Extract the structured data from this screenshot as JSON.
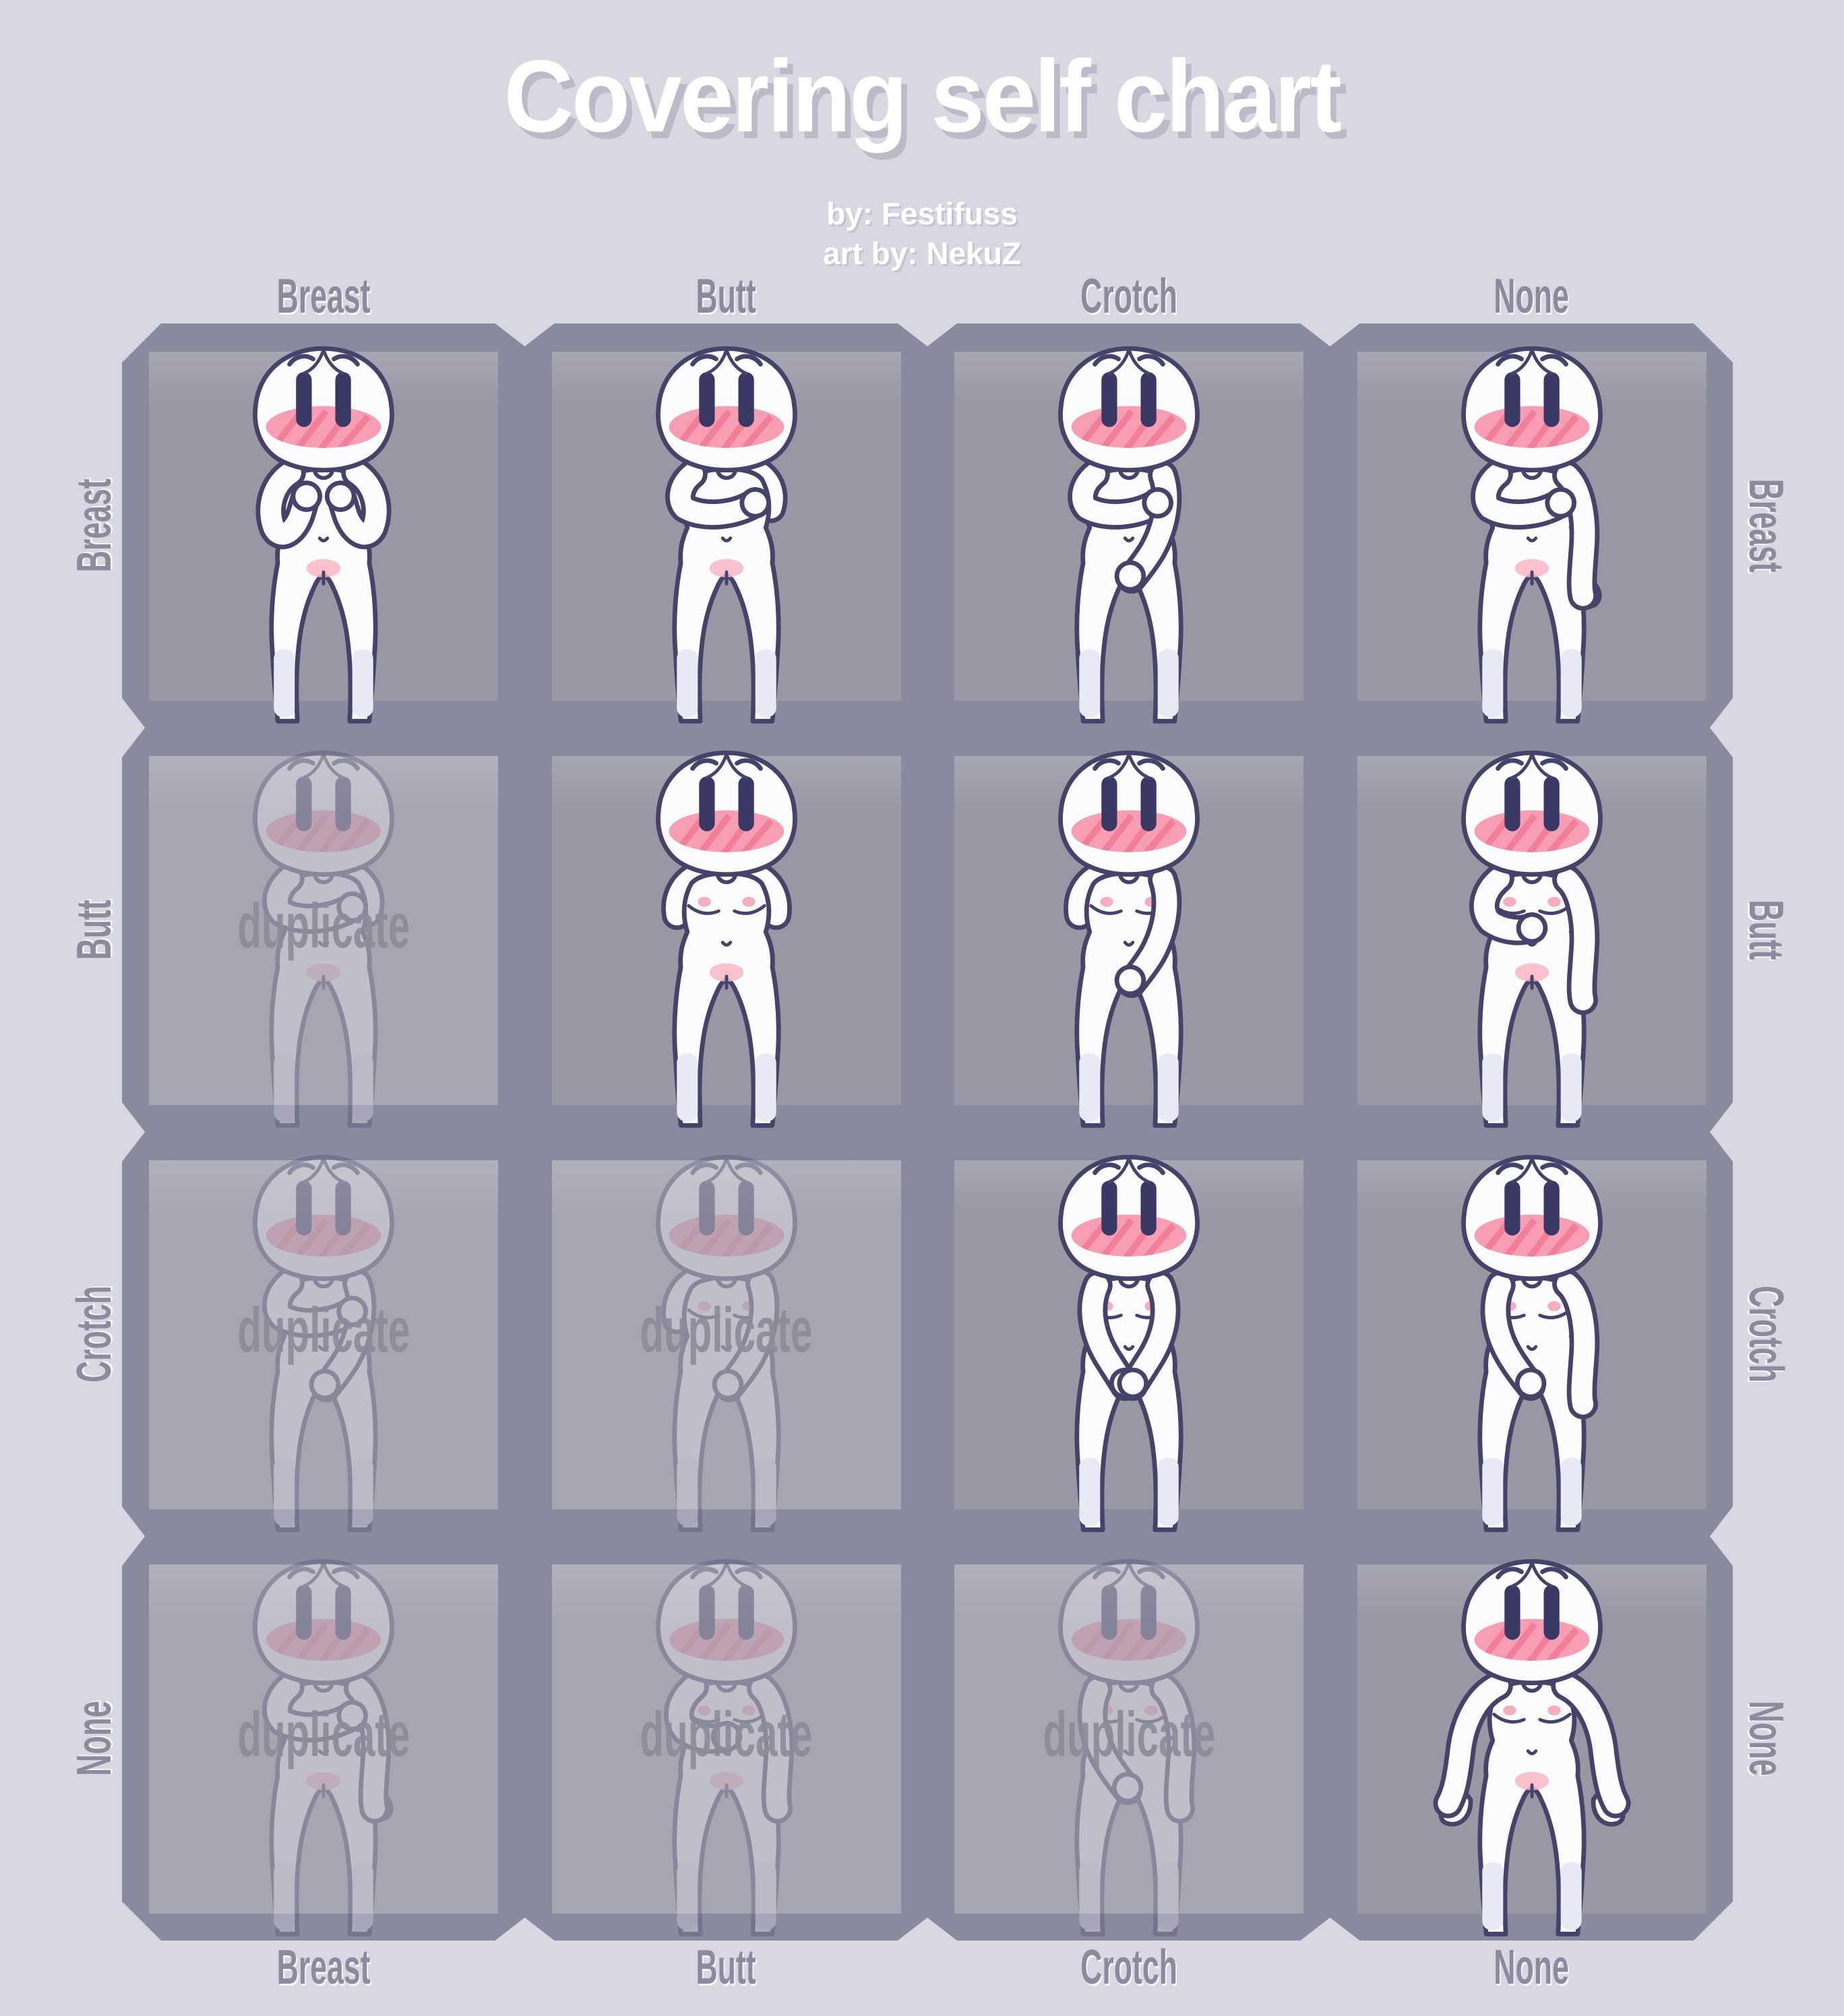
{
  "title": {
    "text": "Covering self chart"
  },
  "credits": {
    "line1": "by: Festifuss",
    "line2": "art by: NekuZ"
  },
  "grid": {
    "column_labels": [
      "Breast",
      "Butt",
      "Crotch",
      "None"
    ],
    "row_labels": [
      "Breast",
      "Butt",
      "Crotch",
      "None"
    ],
    "duplicate_label": "duplicate",
    "cells": [
      {
        "row": "Breast",
        "col": "Breast",
        "covers": [
          "breast"
        ],
        "pose": "both-chest",
        "duplicate": false
      },
      {
        "row": "Breast",
        "col": "Butt",
        "covers": [
          "breast",
          "butt"
        ],
        "pose": "cross-chest-behind",
        "duplicate": false
      },
      {
        "row": "Breast",
        "col": "Crotch",
        "covers": [
          "breast",
          "crotch"
        ],
        "pose": "cross-chest-crotch",
        "duplicate": false
      },
      {
        "row": "Breast",
        "col": "None",
        "covers": [
          "breast"
        ],
        "pose": "cross-chest-hang",
        "duplicate": false
      },
      {
        "row": "Butt",
        "col": "Breast",
        "covers": [
          "butt",
          "breast"
        ],
        "pose": "cross-chest-behind",
        "duplicate": true
      },
      {
        "row": "Butt",
        "col": "Butt",
        "covers": [
          "butt"
        ],
        "pose": "both-behind",
        "duplicate": false
      },
      {
        "row": "Butt",
        "col": "Crotch",
        "covers": [
          "butt",
          "crotch"
        ],
        "pose": "behind-crotch",
        "duplicate": false
      },
      {
        "row": "Butt",
        "col": "None",
        "covers": [
          "butt"
        ],
        "pose": "behind-hang",
        "duplicate": false
      },
      {
        "row": "Crotch",
        "col": "Breast",
        "covers": [
          "crotch",
          "breast"
        ],
        "pose": "cross-chest-crotch",
        "duplicate": true
      },
      {
        "row": "Crotch",
        "col": "Butt",
        "covers": [
          "crotch",
          "butt"
        ],
        "pose": "behind-crotch",
        "duplicate": true
      },
      {
        "row": "Crotch",
        "col": "Crotch",
        "covers": [
          "crotch"
        ],
        "pose": "both-crotch",
        "duplicate": false
      },
      {
        "row": "Crotch",
        "col": "None",
        "covers": [
          "crotch"
        ],
        "pose": "crotch-hang",
        "duplicate": false
      },
      {
        "row": "None",
        "col": "Breast",
        "covers": [
          "breast"
        ],
        "pose": "cross-chest-hang",
        "duplicate": true
      },
      {
        "row": "None",
        "col": "Butt",
        "covers": [
          "butt"
        ],
        "pose": "behind-hang",
        "duplicate": true
      },
      {
        "row": "None",
        "col": "Crotch",
        "covers": [
          "crotch"
        ],
        "pose": "crotch-hang",
        "duplicate": true
      },
      {
        "row": "None",
        "col": "None",
        "covers": [],
        "pose": "spread",
        "duplicate": false
      }
    ]
  },
  "colors": {
    "page_bg": "#d9d8e2",
    "frame": "#8a8a9f",
    "cell": "#9897a3",
    "cell_duplicate": "#a6a5b2",
    "outline": "#454369",
    "eye": "#3a3865",
    "skin": "#fcfcfe",
    "blush": "#f796ac",
    "blush_stripe": "#ee7391",
    "nipple": "#f3aec0",
    "pubic_blush": "#f8b6c6",
    "knee_tint": "#e8e9f4",
    "label": "#8b8a9f",
    "title_text": "#ffffff",
    "title_shadow": "#bbbac9",
    "duplicate_text": "#8d8c9b"
  }
}
